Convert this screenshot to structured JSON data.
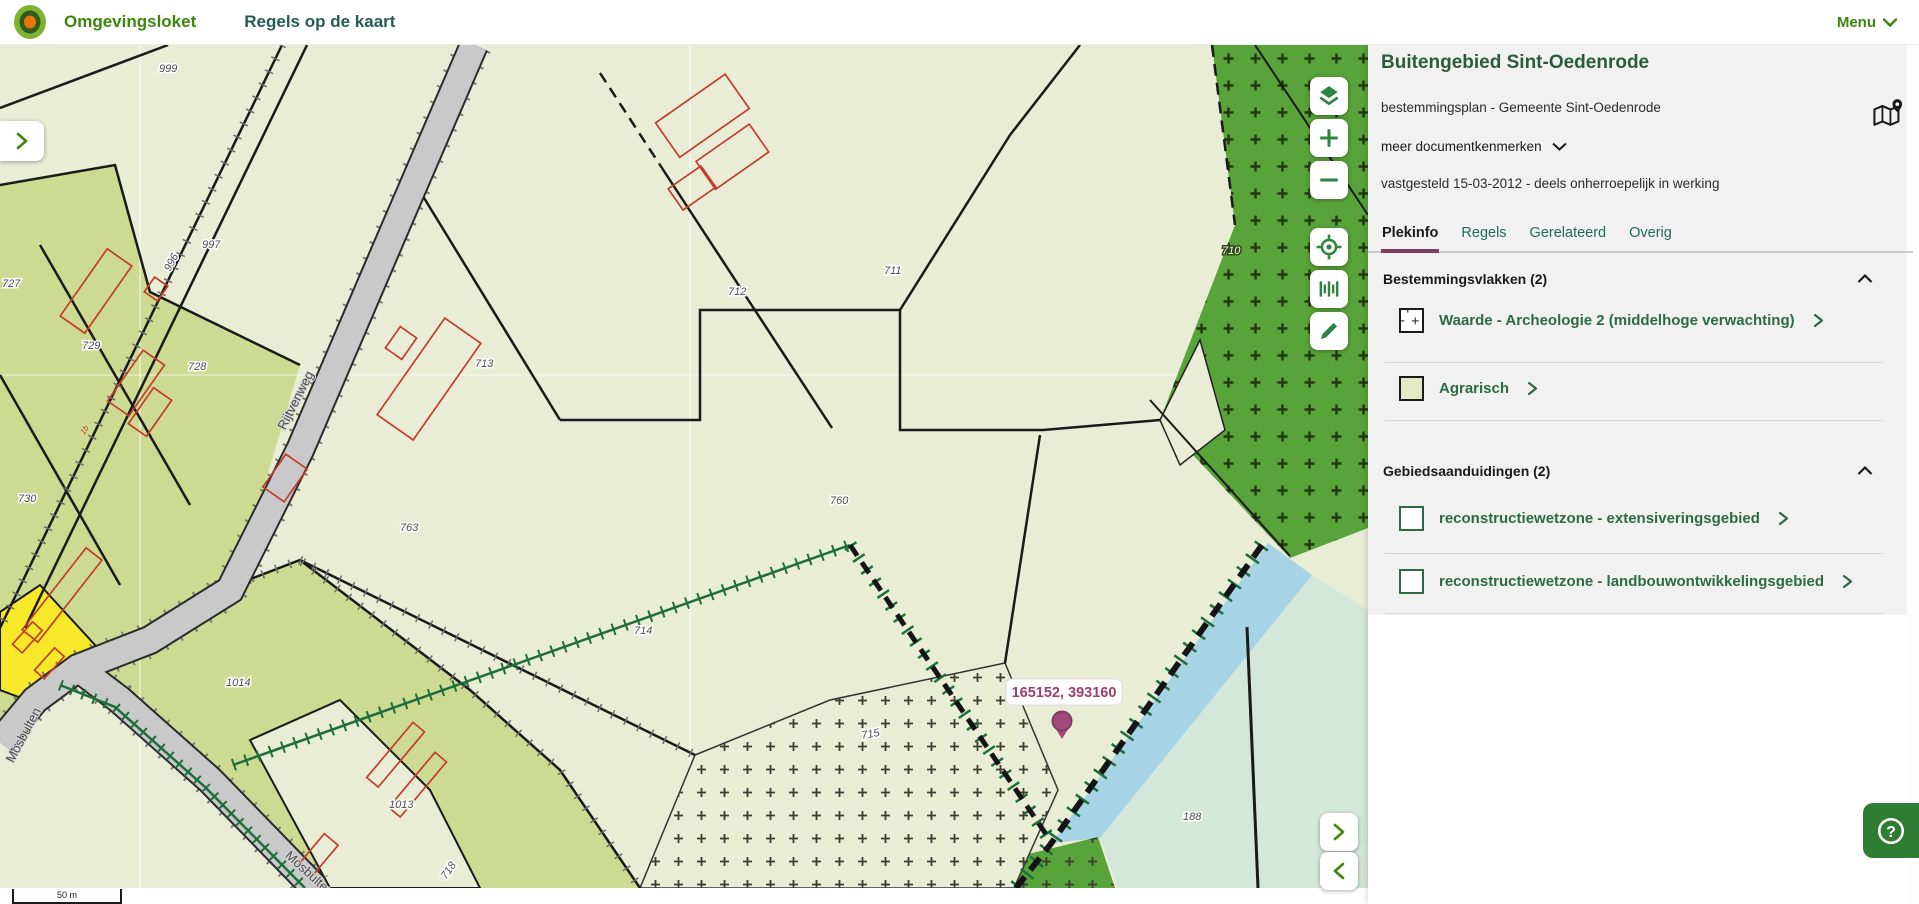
{
  "header": {
    "brand": "Omgevingsloket",
    "page_title": "Regels op de kaart",
    "menu_label": "Menu"
  },
  "panel": {
    "title": "Buitengebied Sint-Oedenrode",
    "subtitle": "bestemmingsplan - Gemeente Sint-Oedenrode",
    "more_documents_label": "meer documentkenmerken",
    "status_line": "vastgesteld 15-03-2012 - deels onherroepelijk in werking",
    "active_tab": "Plekinfo",
    "tabs": [
      {
        "label": "Plekinfo"
      },
      {
        "label": "Regels"
      },
      {
        "label": "Gerelateerd"
      },
      {
        "label": "Overig"
      }
    ],
    "sections": [
      {
        "title": "Bestemmingsvlakken (2)",
        "items": [
          {
            "label": "Waarde - Archeologie 2 (middelhoge verwachting)",
            "swatch": "archeologie-plus-symbol"
          },
          {
            "label": "Agrarisch",
            "swatch": "agrarisch-fill"
          }
        ]
      },
      {
        "title": "Gebiedsaanduidingen (2)",
        "items": [
          {
            "label": "reconstructiewetzone - extensiveringsgebied",
            "swatch": "green-outline"
          },
          {
            "label": "reconstructiewetzone - landbouwontwikkelingsgebied",
            "swatch": "green-outline"
          }
        ]
      }
    ]
  },
  "map": {
    "coordinate_label": "165152, 393160",
    "scale_label": "50 m",
    "road_labels": {
      "r1": "Rijtvenweg",
      "r2": "Mosbulten",
      "r3": "Mosbulten"
    },
    "parcel_labels": {
      "p999": "999",
      "p997": "997",
      "p996": "996",
      "p727": "727",
      "p729": "729",
      "p728": "728",
      "p730": "730",
      "p712": "712",
      "p711": "711",
      "p713": "713",
      "p760": "760",
      "p763": "763",
      "p714": "714",
      "p1014": "1014",
      "p1013": "1013",
      "p715": "715",
      "p718": "718",
      "p710": "710",
      "p188": "188",
      "p1b": "1b"
    },
    "controls": [
      "layers",
      "zoom-in",
      "zoom-out",
      "locate",
      "measure",
      "draw"
    ]
  },
  "colors": {
    "accent_green": "#39870c",
    "panel_link_green": "#2d6a45",
    "tab_active_underline": "#7f3d5f",
    "marker": "#9c4270",
    "water": "#a7d3e6",
    "agrarisch_fill": "#e4e9c5",
    "forest_green": "#58a33a",
    "help_green": "#2e7d32"
  }
}
